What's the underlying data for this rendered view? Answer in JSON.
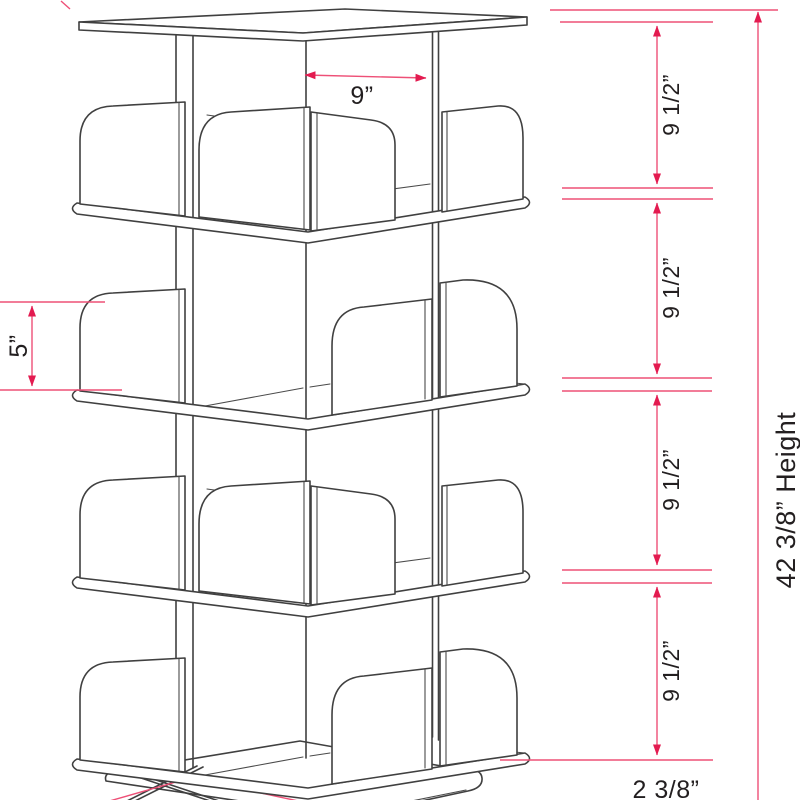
{
  "diagram": {
    "subject": "4-tier rotating bookshelf dimension drawing",
    "dimensions": {
      "shelf_width": "9”",
      "divider_height": "5”",
      "tier_spacings": [
        "9 1/2”",
        "9 1/2”",
        "9 1/2”",
        "9 1/2”"
      ],
      "base_height": "2  3/8”",
      "overall_height": "42  3/8” Height"
    },
    "colors": {
      "dimension_line": "#ee5077",
      "dimension_arrow": "#e31b50",
      "artwork_line": "#404040",
      "label_text": "#231f20",
      "background": "#ffffff"
    }
  }
}
